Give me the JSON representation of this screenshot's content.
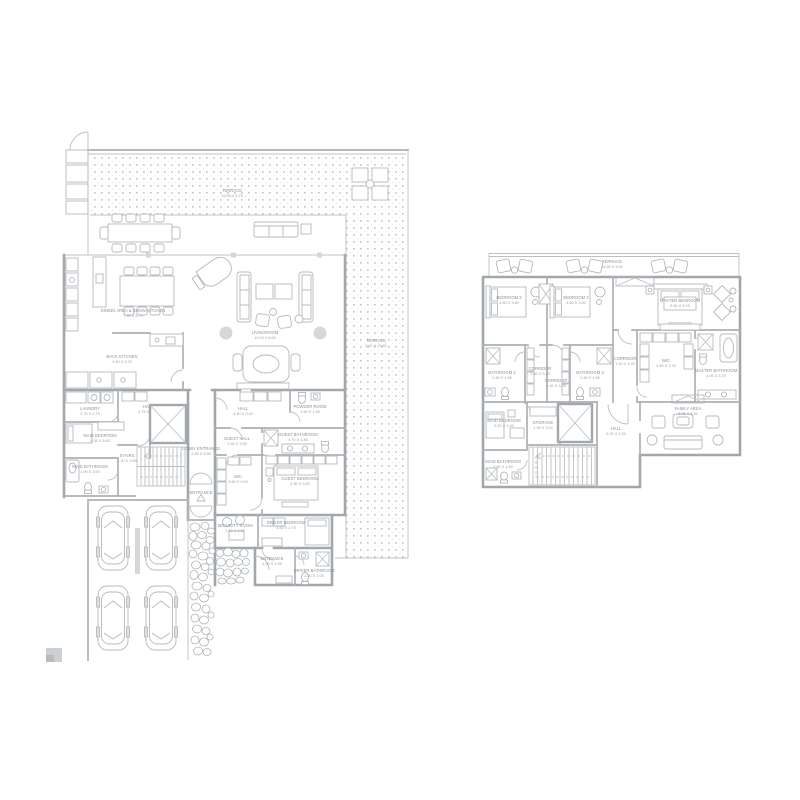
{
  "colors": {
    "wall": "#a2a7ab",
    "partition": "#acb1b5",
    "furniture": "#b4b9bd",
    "text": "#8b9197",
    "terrace_dots": "#c6c9cc",
    "background": "#ffffff"
  },
  "ground_floor": {
    "terrace_top": {
      "name": "TERRACE",
      "dim": "19.05 X 3.75"
    },
    "terrace_right": {
      "name": "TERRACE",
      "dim": "3.60 X 19.60"
    },
    "dining": {
      "name": "DINING AREA & SHOW KITCHEN",
      "dim": "7.80 X 5.75"
    },
    "back_kitchen": {
      "name": "BACK KITCHEN",
      "dim": "3.60 X 3.75"
    },
    "livingroom": {
      "name": "LIVINGROOM",
      "dim": "10.05 X 8.60"
    },
    "laundry": {
      "name": "LAUNDRY",
      "dim": "2.70 X 2.75"
    },
    "hall": {
      "name": "HALL",
      "dim": "4.75 X 3.75"
    },
    "maid_bedroom": {
      "name": "MAID BEDROOM",
      "dim": "3.35 X 3.60"
    },
    "maid_bathroom": {
      "name": "MAID BATHROOM",
      "dim": "1.95 X 3.60"
    },
    "stairs": {
      "name": "STAIRS",
      "dim": "1.20 X 3.60"
    },
    "lobby_entrance": {
      "name": "LOBBY ENTRANCE",
      "dim": "2.95 X 5.85"
    },
    "entrance_arrow": {
      "name": "ENTRANCE"
    },
    "guest_hall_upper": {
      "name": "HALL",
      "dim": "4.60 X 3.40"
    },
    "powder_room": {
      "name": "POWDER ROOM",
      "dim": "1.60 X 1.85"
    },
    "guest_hall": {
      "name": "GUEST HALL",
      "dim": "2.60 X 2.55"
    },
    "guest_bathroom": {
      "name": "GUEST BATHROOM",
      "dim": "4.70 X 1.85"
    },
    "wic": {
      "name": "WIC",
      "dim": "3.60 X 3.60"
    },
    "guest_bedroom": {
      "name": "GUEST BEDROOM",
      "dim": "4.90 X 3.60"
    },
    "security_room": {
      "name": "SECURITY ROOM",
      "dim": "2.60 X 2.55"
    },
    "driver_bedroom": {
      "name": "DRIVER BEDROOM",
      "dim": "3.60 X 2.75"
    },
    "staff_entrance": {
      "name": "ENTRANCE",
      "dim": "2.40 X 1.95"
    },
    "driver_bathroom": {
      "name": "DRIVER BATHROOM",
      "dim": "1.50 X 2.05"
    }
  },
  "upper_floor": {
    "terrace": {
      "name": "TERRACE",
      "dim": "16.60 X 3.00"
    },
    "bedroom2": {
      "name": "BEDROOM 2",
      "dim": "4.60 X 3.60"
    },
    "bedroom3": {
      "name": "BEDROOM 3",
      "dim": "4.60 X 3.60"
    },
    "master_bedroom": {
      "name": "MASTER BEDROOM",
      "dim": "6.60 X 5.25"
    },
    "bathroom2": {
      "name": "BATHROOM 2",
      "dim": "2.60 X 1.85"
    },
    "corridor_a": {
      "name": "CORRIDOR",
      "dim": "1.40 X 3.05"
    },
    "corridor_b": {
      "name": "CORRIDOR",
      "dim": "1.40 X 3.05"
    },
    "bathroom3": {
      "name": "BATHROOM 3",
      "dim": "2.60 X 1.85"
    },
    "corridor_c": {
      "name": "CORRIDOR",
      "dim": "1.40 X 4.20"
    },
    "wic": {
      "name": "WIC",
      "dim": "4.60 X 3.70"
    },
    "master_bathroom": {
      "name": "MASTER BATHROOM",
      "dim": "3.05 X 3.70"
    },
    "maid_bedroom": {
      "name": "MAID BEDROOM",
      "dim": "3.50 X 3.00"
    },
    "storage": {
      "name": "STORAGE",
      "dim": "1.90 X 3.00"
    },
    "maid_bathroom": {
      "name": "MAID BATHROOM",
      "dim": "2.50 X 1.50"
    },
    "hall": {
      "name": "HALL",
      "dim": "5.25 X 3.30"
    },
    "family_area": {
      "name": "FAMILY AREA",
      "dim": "5.25 X 3.30"
    }
  }
}
